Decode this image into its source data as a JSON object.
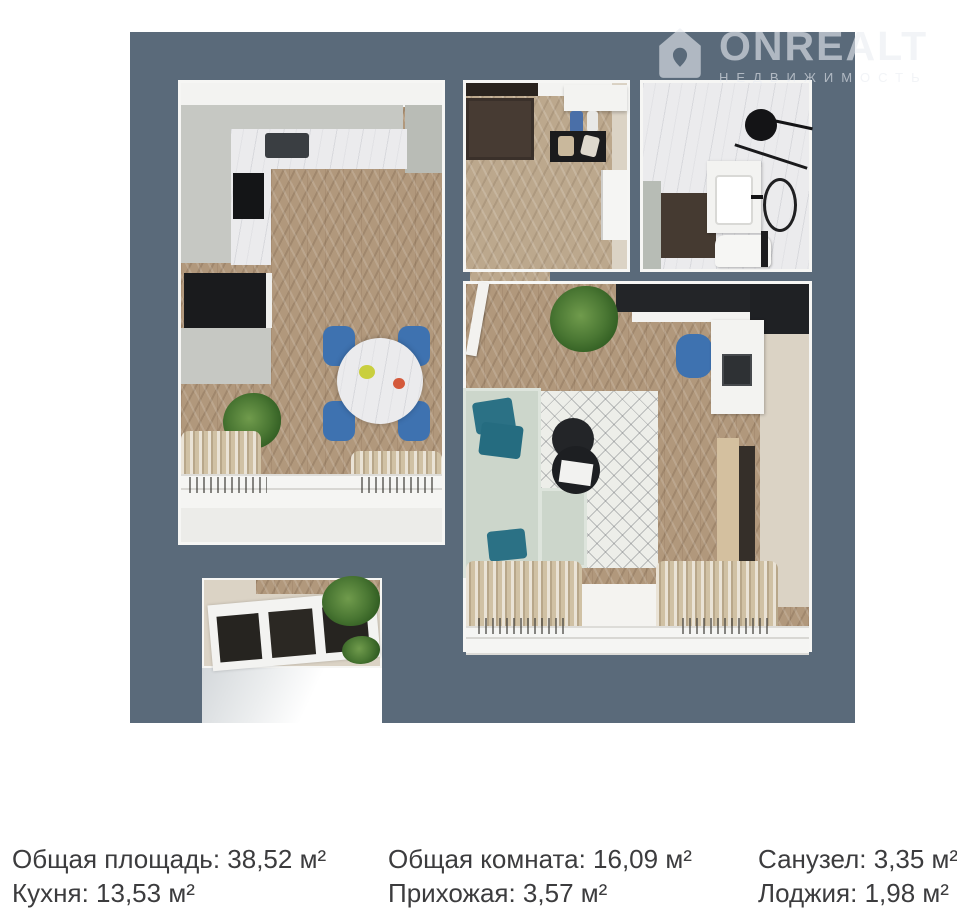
{
  "watermark": {
    "brand": "ONREALT",
    "subtitle": "НЕДВИЖИМОСТЬ"
  },
  "areas": {
    "total": "Общая площадь: 38,52 м²",
    "kitchen": "Кухня: 13,53 м²",
    "living": "Общая комната: 16,09 м²",
    "hallway": "Прихожая: 3,57 м²",
    "bathroom": "Санузел: 3,35 м²",
    "loggia": "Лоджия: 1,98 м²"
  },
  "colors": {
    "wall_slate": "#5a6a7a",
    "floor_wood": "#b1987c",
    "marble": "#ebebed",
    "cabinet_gray": "#c6c8c3",
    "sofa_sage": "#ccd6cb",
    "pillow_teal": "#2b7185",
    "chair_blue": "#3e72b0",
    "rug_white": "#edeee9",
    "curtain_beige": "#d0c1a4",
    "caption_text": "#3c3c3e",
    "watermark_white": "rgba(233,237,242,0.6)"
  }
}
